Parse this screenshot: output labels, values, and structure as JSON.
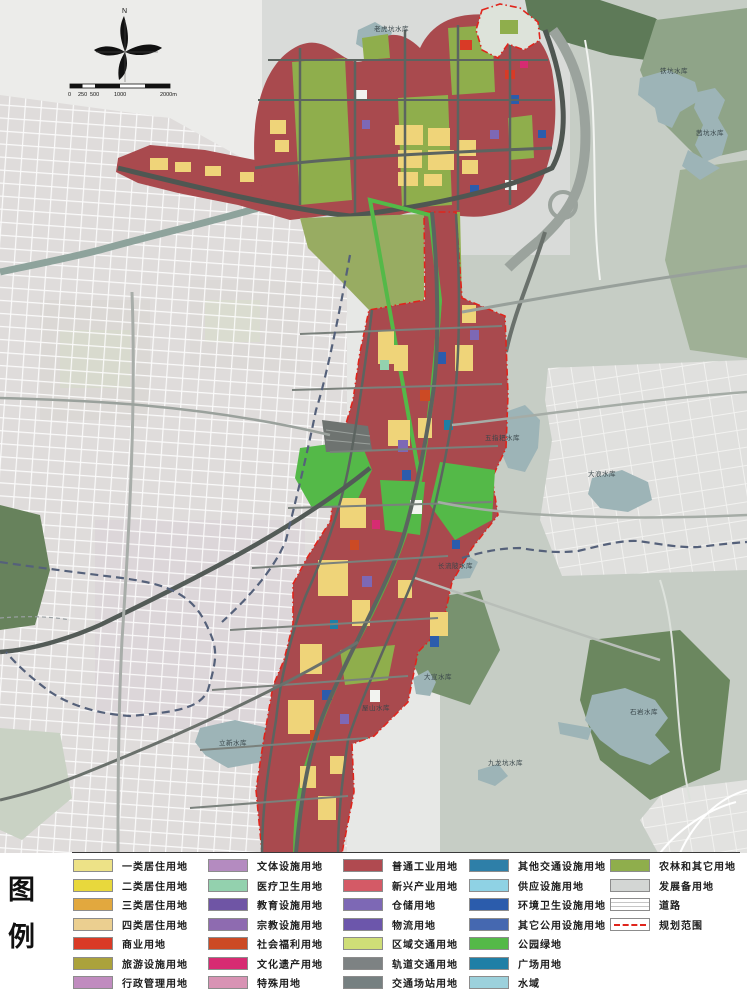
{
  "map": {
    "north_label": "N",
    "scale_ticks": [
      "0",
      "250",
      "500",
      "1000",
      "2000m"
    ],
    "labels": [
      {
        "text": "老虎坑水库"
      },
      {
        "text": "铁坑水库"
      },
      {
        "text": "茜坑水库"
      },
      {
        "text": "五指耙水库"
      },
      {
        "text": "大浪水库"
      },
      {
        "text": "长流陂水库"
      },
      {
        "text": "大宣水库"
      },
      {
        "text": "屋山水库"
      },
      {
        "text": "立新水库"
      },
      {
        "text": "石岩水库"
      },
      {
        "text": "九龙坑水库"
      }
    ],
    "colors": {
      "industry_red_base": "#A94A4E",
      "agri_green": "#8FAE4C",
      "park_green": "#54B948",
      "hills_gray_green": "#C6CDC5",
      "forest_dark": "#5E7A58",
      "water": "#9DB4B7",
      "urban_light": "#E0DDDC",
      "road_dark": "#5C6460",
      "boundary_dash_blue": "#55617A",
      "plan_boundary_red": "#E0251C"
    }
  },
  "legend": {
    "title_chars": [
      "图",
      "例"
    ],
    "columns": [
      {
        "items": [
          {
            "label": "一类居住用地",
            "color": "#EDE287"
          },
          {
            "label": "二类居住用地",
            "color": "#E8D83C"
          },
          {
            "label": "三类居住用地",
            "color": "#E2A83E"
          },
          {
            "label": "四类居住用地",
            "color": "#EBCF90"
          },
          {
            "label": "商业用地",
            "color": "#D93A26"
          },
          {
            "label": "旅游设施用地",
            "color": "#ABA23B"
          },
          {
            "label": "行政管理用地",
            "color": "#C08BBF"
          }
        ]
      },
      {
        "items": [
          {
            "label": "文体设施用地",
            "color": "#B48BC0"
          },
          {
            "label": "医疗卫生用地",
            "color": "#93D1AE"
          },
          {
            "label": "教育设施用地",
            "color": "#6F55A5"
          },
          {
            "label": "宗教设施用地",
            "color": "#8E6BB0"
          },
          {
            "label": "社会福利用地",
            "color": "#CC4A24"
          },
          {
            "label": "文化遗产用地",
            "color": "#D72B72"
          },
          {
            "label": "特殊用地",
            "color": "#D893B4"
          }
        ]
      },
      {
        "items": [
          {
            "label": "普通工业用地",
            "color": "#B04A50"
          },
          {
            "label": "新兴产业用地",
            "color": "#D45A66"
          },
          {
            "label": "仓储用地",
            "color": "#7D68B5"
          },
          {
            "label": "物流用地",
            "color": "#6C56AB"
          },
          {
            "label": "区域交通用地",
            "color": "#CFDE77"
          },
          {
            "label": "轨道交通用地",
            "color": "#7D8283"
          },
          {
            "label": "交通场站用地",
            "color": "#768081"
          }
        ]
      },
      {
        "items": [
          {
            "label": "其他交通设施用地",
            "color": "#2E7FA8"
          },
          {
            "label": "供应设施用地",
            "color": "#8FD2E4"
          },
          {
            "label": "环境卫生设施用地",
            "color": "#2B5CAC"
          },
          {
            "label": "其它公用设施用地",
            "color": "#4568B0"
          },
          {
            "label": "公园绿地",
            "color": "#54B948"
          },
          {
            "label": "广场用地",
            "color": "#1F7FA6"
          },
          {
            "label": "水域",
            "color": "#9CD1DC"
          }
        ]
      },
      {
        "items": [
          {
            "label": "农林和其它用地",
            "color": "#8FAE4C"
          },
          {
            "label": "发展备用地",
            "color": "#D3D6D4"
          },
          {
            "label": "道路",
            "type": "road"
          },
          {
            "label": "规划范围",
            "type": "boundary",
            "color": "#E0251C"
          }
        ]
      }
    ]
  }
}
